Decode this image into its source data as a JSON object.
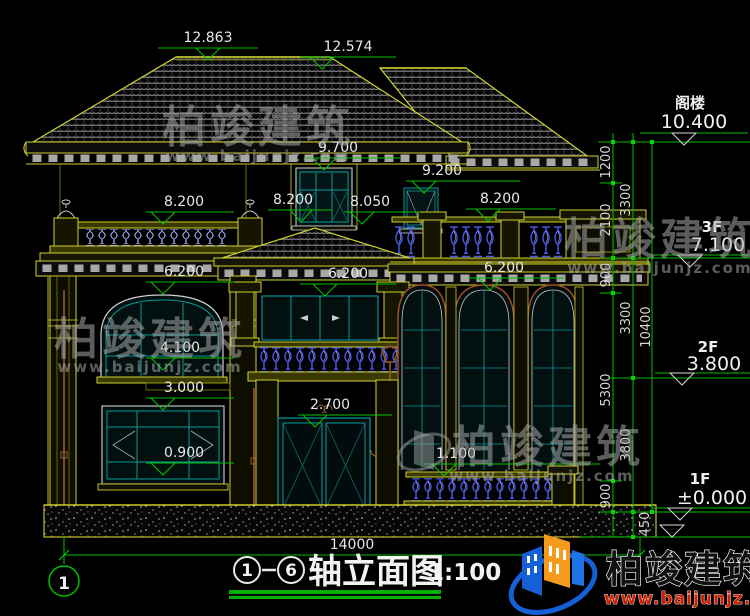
{
  "drawing_title": {
    "axis_start": "1",
    "axis_end": "6",
    "name": "轴立面图",
    "scale": "1:100"
  },
  "axis_bubble": "1",
  "overall_width": "14000",
  "floors": {
    "attic": {
      "label": "阁楼",
      "elev": "10.400"
    },
    "f3": {
      "label": "3F",
      "elev": "7.100"
    },
    "f2": {
      "label": "2F",
      "elev": "3.800"
    },
    "f1": {
      "label": "1F",
      "elev": "±0.000"
    }
  },
  "dim_chain": {
    "inner": [
      "1200",
      "2100",
      "900",
      "5300",
      "900"
    ],
    "middle": [
      "3300",
      "3300",
      "3800"
    ],
    "total": "10400",
    "foundation": "450"
  },
  "spot_elevations": {
    "main_ridge": "12.863",
    "secondary_ridge": "12.574",
    "eave": "9.700",
    "attic_window_head": "9.200",
    "left_parapet": "8.200",
    "portico_ridge": "8.200",
    "dormer_sill": "8.050",
    "right_parapet": "8.200",
    "left_window_head_2f": "6.200",
    "balcony_door_head": "6.200",
    "right_window_head": "6.200",
    "left_window_sill_2f": "4.100",
    "left_window_head_1f": "3.000",
    "entry_door_head": "2.700",
    "terrace_rail": "1.100",
    "left_window_sill_1f": "0.900"
  },
  "watermark": {
    "brand": "柏竣建筑",
    "url": "www.baijunjz.com"
  },
  "logo": {
    "brand": "柏竣建筑",
    "url": "www.baijunjz.com"
  },
  "colors": {
    "cad_green": "#00c000",
    "wall_yellow": "#d6d62a",
    "window_cyan": "#0a9a9a",
    "baluster_blue": "#4a5cf0",
    "trim_brown": "#a04a28",
    "logo_blue": "#1560d6",
    "logo_orange": "#f59a1d",
    "logo_red": "#cc2200"
  }
}
